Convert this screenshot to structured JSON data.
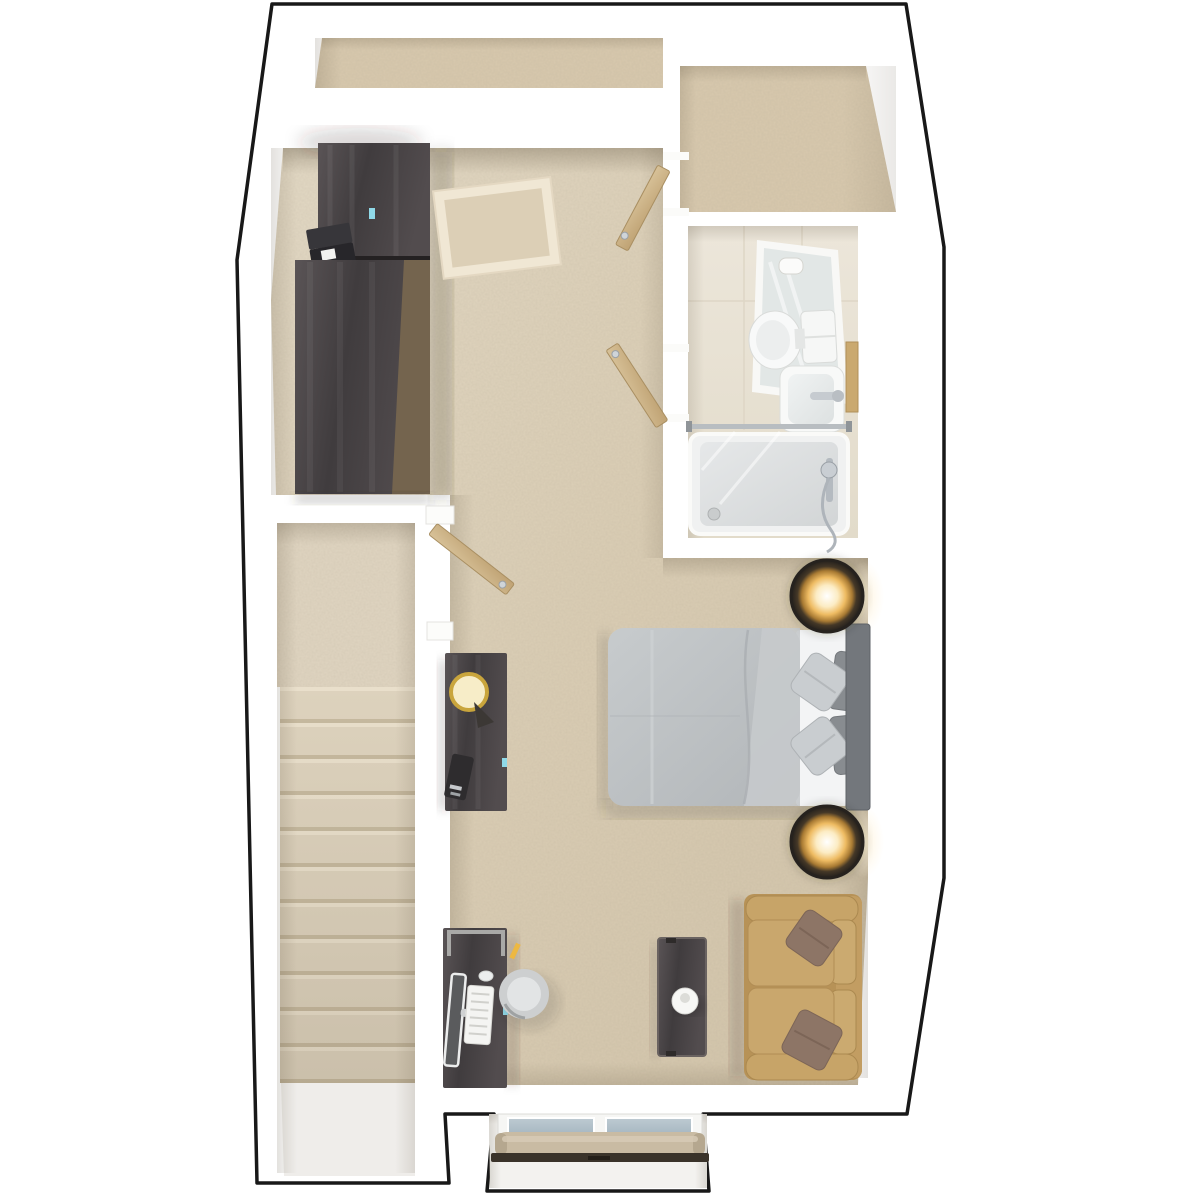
{
  "app": {
    "type": "3d-floor-plan-rendering",
    "view": "top-down-dollhouse",
    "visible_text": "none"
  },
  "canvas": {
    "width": 1200,
    "height": 1200,
    "background": "#ffffff",
    "outline": "#181818"
  },
  "palette": {
    "wall": "#ffffff",
    "outline": "#181818",
    "carpet_main": "#dccfb7",
    "carpet_closet": "#d8c9ae",
    "carpet_stairs": "#ddd2bd",
    "tile_bathroom": "#e9e3d6",
    "landing_floor": "#efedea",
    "wood_dark": "#4b4648",
    "wood_side": "#74644e",
    "wood_light_door": "#cdb58b",
    "bed_duvet": "#bcc0c3",
    "bed_sheet": "#f3f4f5",
    "bed_headboard": "#73777c",
    "pillow_light": "#c9cdd0",
    "pillow_dark": "#888c90",
    "sofa_base": "#b79257",
    "sofa_cushion": "#c9a76d",
    "sofa_pillow": "#8d7566",
    "lamp_glow": "#eebb62",
    "gold_lamp": "#e8c04a",
    "chair": "#cdcfd0",
    "curtain": "#c9bba3",
    "curtain_rail": "#3a332a",
    "glass": "#b2c0c9",
    "vase": "#f7f7f5",
    "towel_rail": "#caa96f",
    "chrome": "#c9ced3",
    "tag_accent": "#8fd9e8"
  },
  "rooms": [
    {
      "id": "main-room",
      "label": "studio bedroom / living area",
      "floor": "carpet"
    },
    {
      "id": "eaves-storage",
      "label": "eaves storage strip",
      "floor": "carpet"
    },
    {
      "id": "closet-room",
      "label": "walk-in closet / landing room",
      "floor": "carpet"
    },
    {
      "id": "bathroom",
      "label": "shower room",
      "floor": "tile"
    },
    {
      "id": "stairwell",
      "label": "staircase",
      "floor": "carpet-steps"
    },
    {
      "id": "window-bay",
      "label": "window bay",
      "floor": "sill"
    }
  ],
  "furniture": [
    {
      "name": "wardrobe-tall",
      "room": "main-room"
    },
    {
      "name": "dresser",
      "room": "main-room"
    },
    {
      "name": "laptop",
      "room": "main-room"
    },
    {
      "name": "area-rug",
      "room": "main-room"
    },
    {
      "name": "closet-door",
      "room": "main-room"
    },
    {
      "name": "bathroom-door",
      "room": "main-room"
    },
    {
      "name": "stair-door",
      "room": "main-room"
    },
    {
      "name": "bedside-cabinet",
      "room": "main-room"
    },
    {
      "name": "table-lamp-gold",
      "room": "main-room"
    },
    {
      "name": "double-bed",
      "room": "main-room"
    },
    {
      "name": "round-nightstand-top",
      "room": "main-room"
    },
    {
      "name": "round-nightstand-bottom",
      "room": "main-room"
    },
    {
      "name": "desk",
      "room": "main-room"
    },
    {
      "name": "monitor",
      "room": "main-room"
    },
    {
      "name": "keyboard",
      "room": "main-room"
    },
    {
      "name": "mouse",
      "room": "main-room"
    },
    {
      "name": "desk-chair",
      "room": "main-room"
    },
    {
      "name": "console-table",
      "room": "main-room"
    },
    {
      "name": "vase",
      "room": "main-room"
    },
    {
      "name": "loveseat-sofa",
      "room": "main-room"
    },
    {
      "name": "sofa-pillow-top",
      "room": "main-room"
    },
    {
      "name": "sofa-pillow-bottom",
      "room": "main-room"
    }
  ],
  "fixtures": [
    {
      "name": "toilet",
      "room": "bathroom"
    },
    {
      "name": "wash-basin",
      "room": "bathroom"
    },
    {
      "name": "mirror",
      "room": "bathroom"
    },
    {
      "name": "toilet-roll-holder",
      "room": "bathroom"
    },
    {
      "name": "shower-tray",
      "room": "bathroom"
    },
    {
      "name": "shower-screen",
      "room": "bathroom"
    },
    {
      "name": "shower-valve",
      "room": "bathroom"
    },
    {
      "name": "towel-rail",
      "room": "bathroom"
    },
    {
      "name": "window",
      "room": "window-bay"
    },
    {
      "name": "roller-curtain",
      "room": "window-bay"
    },
    {
      "name": "curtain-rail",
      "room": "window-bay"
    },
    {
      "name": "staircase-steps",
      "room": "stairwell",
      "count": 11
    }
  ]
}
